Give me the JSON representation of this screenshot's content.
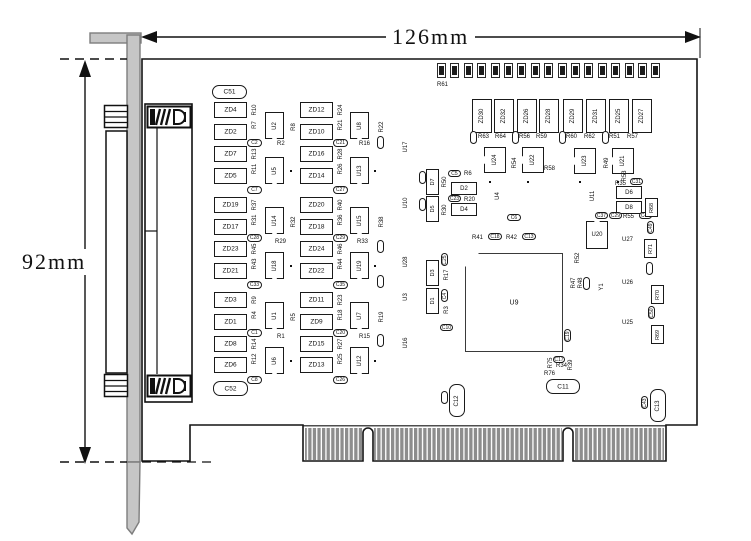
{
  "dimensions": {
    "width_label": "126mm",
    "height_label": "92mm"
  },
  "board": {
    "outline_color": "#141414",
    "bracket_fill": "#c6c6c6",
    "bracket_stroke": "#7d7d7d",
    "finger_color": "#8d8d8d",
    "background": "#ffffff"
  },
  "led_row": {
    "count": 17,
    "x": 437,
    "y": 63,
    "step": 13.4,
    "w": 9,
    "h": 15,
    "label": "R61"
  },
  "components": [
    {
      "t": "rr",
      "l": "C51",
      "x": 212,
      "y": 85,
      "w": 35,
      "h": 14
    },
    {
      "t": "zd",
      "l": "ZD4",
      "x": 214,
      "y": 102
    },
    {
      "t": "zd",
      "l": "ZD2",
      "x": 214,
      "y": 124
    },
    {
      "t": "zd",
      "l": "ZD7",
      "x": 214,
      "y": 146
    },
    {
      "t": "zd",
      "l": "ZD5",
      "x": 214,
      "y": 168
    },
    {
      "t": "zd",
      "l": "ZD19",
      "x": 214,
      "y": 197
    },
    {
      "t": "zd",
      "l": "ZD17",
      "x": 214,
      "y": 219
    },
    {
      "t": "zd",
      "l": "ZD23",
      "x": 214,
      "y": 241
    },
    {
      "t": "zd",
      "l": "ZD21",
      "x": 214,
      "y": 263
    },
    {
      "t": "zd",
      "l": "ZD3",
      "x": 214,
      "y": 292
    },
    {
      "t": "zd",
      "l": "ZD1",
      "x": 214,
      "y": 314
    },
    {
      "t": "zd",
      "l": "ZD8",
      "x": 214,
      "y": 336
    },
    {
      "t": "zd",
      "l": "ZD6",
      "x": 214,
      "y": 357
    },
    {
      "t": "zd",
      "l": "ZD12",
      "x": 300,
      "y": 102
    },
    {
      "t": "zd",
      "l": "ZD10",
      "x": 300,
      "y": 124
    },
    {
      "t": "zd",
      "l": "ZD16",
      "x": 300,
      "y": 146
    },
    {
      "t": "zd",
      "l": "ZD14",
      "x": 300,
      "y": 168
    },
    {
      "t": "zd",
      "l": "ZD20",
      "x": 300,
      "y": 197
    },
    {
      "t": "zd",
      "l": "ZD18",
      "x": 300,
      "y": 219
    },
    {
      "t": "zd",
      "l": "ZD24",
      "x": 300,
      "y": 241
    },
    {
      "t": "zd",
      "l": "ZD22",
      "x": 300,
      "y": 263
    },
    {
      "t": "zd",
      "l": "ZD11",
      "x": 300,
      "y": 292
    },
    {
      "t": "zd",
      "l": "ZD9",
      "x": 300,
      "y": 314
    },
    {
      "t": "zd",
      "l": "ZD15",
      "x": 300,
      "y": 336
    },
    {
      "t": "zd",
      "l": "ZD13",
      "x": 300,
      "y": 357
    },
    {
      "t": "vt",
      "l": "R10",
      "x": 250,
      "y": 103
    },
    {
      "t": "vt",
      "l": "R7",
      "x": 250,
      "y": 118
    },
    {
      "t": "cap",
      "l": "C2",
      "x": 247,
      "y": 139
    },
    {
      "t": "vt",
      "l": "R13",
      "x": 250,
      "y": 147
    },
    {
      "t": "vt",
      "l": "R11",
      "x": 250,
      "y": 162
    },
    {
      "t": "cap",
      "l": "C7",
      "x": 247,
      "y": 186
    },
    {
      "t": "vt",
      "l": "R37",
      "x": 250,
      "y": 198
    },
    {
      "t": "vt",
      "l": "R31",
      "x": 250,
      "y": 213
    },
    {
      "t": "cap",
      "l": "C28",
      "x": 247,
      "y": 234
    },
    {
      "t": "vt",
      "l": "R45",
      "x": 250,
      "y": 242
    },
    {
      "t": "vt",
      "l": "R43",
      "x": 250,
      "y": 257
    },
    {
      "t": "cap",
      "l": "C33",
      "x": 247,
      "y": 281
    },
    {
      "t": "vt",
      "l": "R9",
      "x": 250,
      "y": 293
    },
    {
      "t": "vt",
      "l": "R4",
      "x": 250,
      "y": 308
    },
    {
      "t": "cap",
      "l": "C1",
      "x": 247,
      "y": 329
    },
    {
      "t": "vt",
      "l": "R14",
      "x": 250,
      "y": 337
    },
    {
      "t": "vt",
      "l": "R12",
      "x": 250,
      "y": 352
    },
    {
      "t": "cap",
      "l": "C8",
      "x": 247,
      "y": 376
    },
    {
      "t": "vt",
      "l": "R24",
      "x": 336,
      "y": 103
    },
    {
      "t": "vt",
      "l": "R21",
      "x": 336,
      "y": 118
    },
    {
      "t": "cap",
      "l": "C21",
      "x": 333,
      "y": 139
    },
    {
      "t": "vt",
      "l": "R28",
      "x": 336,
      "y": 147
    },
    {
      "t": "vt",
      "l": "R26",
      "x": 336,
      "y": 162
    },
    {
      "t": "cap",
      "l": "C27",
      "x": 333,
      "y": 186
    },
    {
      "t": "vt",
      "l": "R40",
      "x": 336,
      "y": 198
    },
    {
      "t": "vt",
      "l": "R36",
      "x": 336,
      "y": 213
    },
    {
      "t": "cap",
      "l": "C29",
      "x": 333,
      "y": 234
    },
    {
      "t": "vt",
      "l": "R46",
      "x": 336,
      "y": 242
    },
    {
      "t": "vt",
      "l": "R44",
      "x": 336,
      "y": 257
    },
    {
      "t": "cap",
      "l": "C35",
      "x": 333,
      "y": 281
    },
    {
      "t": "vt",
      "l": "R23",
      "x": 336,
      "y": 293
    },
    {
      "t": "vt",
      "l": "R18",
      "x": 336,
      "y": 308
    },
    {
      "t": "cap",
      "l": "C20",
      "x": 333,
      "y": 329
    },
    {
      "t": "vt",
      "l": "R27",
      "x": 336,
      "y": 337
    },
    {
      "t": "vt",
      "l": "R25",
      "x": 336,
      "y": 352
    },
    {
      "t": "cap",
      "l": "C26",
      "x": 333,
      "y": 376
    },
    {
      "t": "u",
      "l": "U2",
      "x": 265,
      "y": 112
    },
    {
      "t": "u",
      "l": "U5",
      "x": 265,
      "y": 157
    },
    {
      "t": "u",
      "l": "U14",
      "x": 265,
      "y": 207
    },
    {
      "t": "u",
      "l": "U18",
      "x": 265,
      "y": 252
    },
    {
      "t": "u",
      "l": "U1",
      "x": 265,
      "y": 302
    },
    {
      "t": "u",
      "l": "U6",
      "x": 265,
      "y": 347
    },
    {
      "t": "u",
      "l": "U8",
      "x": 350,
      "y": 112
    },
    {
      "t": "u",
      "l": "U13",
      "x": 350,
      "y": 157
    },
    {
      "t": "u",
      "l": "U15",
      "x": 350,
      "y": 207
    },
    {
      "t": "u",
      "l": "U19",
      "x": 350,
      "y": 252
    },
    {
      "t": "u",
      "l": "U7",
      "x": 350,
      "y": 302
    },
    {
      "t": "u",
      "l": "U12",
      "x": 350,
      "y": 347
    },
    {
      "t": "ht",
      "l": "R2",
      "x": 277,
      "y": 140
    },
    {
      "t": "ht",
      "l": "R16",
      "x": 359,
      "y": 140
    },
    {
      "t": "ht",
      "l": "R29",
      "x": 275,
      "y": 238
    },
    {
      "t": "ht",
      "l": "R33",
      "x": 357,
      "y": 238
    },
    {
      "t": "ht",
      "l": "R1",
      "x": 277,
      "y": 333
    },
    {
      "t": "ht",
      "l": "R15",
      "x": 359,
      "y": 333
    },
    {
      "t": "vt",
      "l": "R8",
      "x": 289,
      "y": 120
    },
    {
      "t": "vt",
      "l": "R32",
      "x": 289,
      "y": 215
    },
    {
      "t": "vt",
      "l": "R5",
      "x": 289,
      "y": 310
    },
    {
      "t": "vt",
      "l": "R22",
      "x": 377,
      "y": 120
    },
    {
      "t": "vt",
      "l": "R38",
      "x": 377,
      "y": 215
    },
    {
      "t": "vt",
      "l": "R19",
      "x": 377,
      "y": 310
    },
    {
      "t": "capv",
      "l": "",
      "x": 377,
      "y": 136
    },
    {
      "t": "capv",
      "l": "",
      "x": 377,
      "y": 240
    },
    {
      "t": "capv",
      "l": "",
      "x": 377,
      "y": 275
    },
    {
      "t": "capv",
      "l": "",
      "x": 377,
      "y": 334
    },
    {
      "t": "vt",
      "l": "U17",
      "x": 401,
      "y": 140
    },
    {
      "t": "vt",
      "l": "U10",
      "x": 401,
      "y": 196
    },
    {
      "t": "vt",
      "l": "U28",
      "x": 401,
      "y": 255
    },
    {
      "t": "vt",
      "l": "U3",
      "x": 401,
      "y": 290
    },
    {
      "t": "vt",
      "l": "U16",
      "x": 401,
      "y": 336
    },
    {
      "t": "dot",
      "x": 290,
      "y": 170
    },
    {
      "t": "dot",
      "x": 290,
      "y": 265
    },
    {
      "t": "dot",
      "x": 290,
      "y": 360
    },
    {
      "t": "dot",
      "x": 374,
      "y": 170
    },
    {
      "t": "dot",
      "x": 374,
      "y": 265
    },
    {
      "t": "dot",
      "x": 374,
      "y": 360
    },
    {
      "t": "zdv",
      "l": "ZD30",
      "x": 472,
      "y": 99
    },
    {
      "t": "zdv",
      "l": "ZD32",
      "x": 494,
      "y": 99
    },
    {
      "t": "zdv",
      "l": "ZD26",
      "x": 517,
      "y": 99
    },
    {
      "t": "zdv",
      "l": "ZD28",
      "x": 539,
      "y": 99
    },
    {
      "t": "zdv",
      "l": "ZD29",
      "x": 563,
      "y": 99
    },
    {
      "t": "zdv",
      "l": "ZD31",
      "x": 586,
      "y": 99
    },
    {
      "t": "zdv",
      "l": "ZD25",
      "x": 609,
      "y": 99
    },
    {
      "t": "zdv",
      "l": "ZD27",
      "x": 632,
      "y": 99
    },
    {
      "t": "capv",
      "l": "",
      "x": 470,
      "y": 131
    },
    {
      "t": "ht",
      "l": "R63",
      "x": 478,
      "y": 133
    },
    {
      "t": "ht",
      "l": "R64",
      "x": 495,
      "y": 133
    },
    {
      "t": "capv",
      "l": "",
      "x": 512,
      "y": 131
    },
    {
      "t": "ht",
      "l": "R56",
      "x": 519,
      "y": 133
    },
    {
      "t": "ht",
      "l": "R59",
      "x": 536,
      "y": 133
    },
    {
      "t": "capv",
      "l": "",
      "x": 559,
      "y": 131
    },
    {
      "t": "ht",
      "l": "R60",
      "x": 566,
      "y": 133
    },
    {
      "t": "ht",
      "l": "R62",
      "x": 584,
      "y": 133
    },
    {
      "t": "capv",
      "l": "",
      "x": 602,
      "y": 131
    },
    {
      "t": "ht",
      "l": "R51",
      "x": 609,
      "y": 133
    },
    {
      "t": "ht",
      "l": "R57",
      "x": 627,
      "y": 133
    },
    {
      "t": "ul",
      "l": "U24",
      "x": 484,
      "y": 147
    },
    {
      "t": "ul",
      "l": "U22",
      "x": 522,
      "y": 147
    },
    {
      "t": "ul",
      "l": "U23",
      "x": 574,
      "y": 148
    },
    {
      "t": "ul",
      "l": "U21",
      "x": 612,
      "y": 148
    },
    {
      "t": "vt",
      "l": "R54",
      "x": 510,
      "y": 156
    },
    {
      "t": "ht",
      "l": "R58",
      "x": 544,
      "y": 165
    },
    {
      "t": "vt",
      "l": "R49",
      "x": 602,
      "y": 156
    },
    {
      "t": "dot",
      "x": 489,
      "y": 181
    },
    {
      "t": "dot",
      "x": 527,
      "y": 181
    },
    {
      "t": "dot",
      "x": 579,
      "y": 181
    },
    {
      "t": "dot",
      "x": 617,
      "y": 181
    },
    {
      "t": "capv",
      "l": "",
      "x": 419,
      "y": 171
    },
    {
      "t": "rectv",
      "l": "D7",
      "x": 426,
      "y": 169,
      "w": 13,
      "h": 26
    },
    {
      "t": "vt",
      "l": "R50",
      "x": 440,
      "y": 175
    },
    {
      "t": "capv",
      "l": "",
      "x": 419,
      "y": 198
    },
    {
      "t": "rectv",
      "l": "D5",
      "x": 426,
      "y": 196,
      "w": 13,
      "h": 26
    },
    {
      "t": "vt",
      "l": "R30",
      "x": 440,
      "y": 203
    },
    {
      "t": "cap",
      "l": "C5",
      "x": 448,
      "y": 170,
      "w": 13,
      "h": 7
    },
    {
      "t": "ht",
      "l": "R6",
      "x": 464,
      "y": 170
    },
    {
      "t": "rect",
      "l": "D2",
      "x": 451,
      "y": 182
    },
    {
      "t": "cap",
      "l": "C23",
      "x": 448,
      "y": 195,
      "w": 13,
      "h": 7
    },
    {
      "t": "ht",
      "l": "R20",
      "x": 464,
      "y": 196
    },
    {
      "t": "rect",
      "l": "D4",
      "x": 451,
      "y": 203
    },
    {
      "t": "vt",
      "l": "U4",
      "x": 493,
      "y": 189
    },
    {
      "t": "cap",
      "l": "C6",
      "x": 507,
      "y": 214,
      "w": 14,
      "h": 7
    },
    {
      "t": "ht",
      "l": "R41",
      "x": 472,
      "y": 234
    },
    {
      "t": "cap",
      "l": "C18",
      "x": 488,
      "y": 233,
      "w": 14,
      "h": 7
    },
    {
      "t": "ht",
      "l": "R42",
      "x": 506,
      "y": 234
    },
    {
      "t": "cap",
      "l": "C13",
      "x": 522,
      "y": 233,
      "w": 14,
      "h": 7
    },
    {
      "t": "capv",
      "l": "C25",
      "x": 441,
      "y": 253
    },
    {
      "t": "vt",
      "l": "R17",
      "x": 442,
      "y": 268
    },
    {
      "t": "rectv",
      "l": "D3",
      "x": 426,
      "y": 260,
      "w": 13,
      "h": 26
    },
    {
      "t": "capv",
      "l": "C4",
      "x": 441,
      "y": 289
    },
    {
      "t": "vt",
      "l": "R3",
      "x": 442,
      "y": 303
    },
    {
      "t": "rectv",
      "l": "D1",
      "x": 426,
      "y": 288,
      "w": 13,
      "h": 26
    },
    {
      "t": "cap",
      "l": "C10",
      "x": 440,
      "y": 324,
      "w": 13,
      "h": 7
    },
    {
      "t": "chip",
      "l": "U9",
      "x": 465,
      "y": 253,
      "w": 98,
      "h": 99
    },
    {
      "t": "vt",
      "l": "R52",
      "x": 573,
      "y": 251
    },
    {
      "t": "vt",
      "l": "R47",
      "x": 569,
      "y": 276
    },
    {
      "t": "vt",
      "l": "R48",
      "x": 576,
      "y": 276
    },
    {
      "t": "capv",
      "l": "",
      "x": 583,
      "y": 277
    },
    {
      "t": "vt",
      "l": "Y1",
      "x": 597,
      "y": 280
    },
    {
      "t": "capv",
      "l": "C19",
      "x": 564,
      "y": 329
    },
    {
      "t": "un",
      "l": "U20",
      "x": 586,
      "y": 221,
      "w": 22,
      "h": 28
    },
    {
      "t": "vt",
      "l": "U11",
      "x": 588,
      "y": 189
    },
    {
      "t": "vt",
      "l": "R53",
      "x": 620,
      "y": 169
    },
    {
      "t": "ht",
      "l": "R35",
      "x": 615,
      "y": 180
    },
    {
      "t": "cap",
      "l": "C31",
      "x": 630,
      "y": 178,
      "w": 13,
      "h": 7
    },
    {
      "t": "rect",
      "l": "D6",
      "x": 616,
      "y": 186
    },
    {
      "t": "rect",
      "l": "D8",
      "x": 616,
      "y": 201
    },
    {
      "t": "cap",
      "l": "C37",
      "x": 595,
      "y": 212,
      "w": 13,
      "h": 7
    },
    {
      "t": "cap",
      "l": "C29",
      "x": 609,
      "y": 212,
      "w": 13,
      "h": 7
    },
    {
      "t": "ht",
      "l": "R55",
      "x": 623,
      "y": 213
    },
    {
      "t": "cap",
      "l": "C42",
      "x": 639,
      "y": 212,
      "w": 13,
      "h": 7
    },
    {
      "t": "rectv",
      "l": "R68",
      "x": 645,
      "y": 198
    },
    {
      "t": "capv",
      "l": "C49",
      "x": 647,
      "y": 221
    },
    {
      "t": "ht",
      "l": "U27",
      "x": 622,
      "y": 236
    },
    {
      "t": "rectv",
      "l": "R71",
      "x": 644,
      "y": 239
    },
    {
      "t": "capv",
      "l": "",
      "x": 646,
      "y": 262
    },
    {
      "t": "ht",
      "l": "U26",
      "x": 622,
      "y": 279
    },
    {
      "t": "rectv",
      "l": "R70",
      "x": 651,
      "y": 285
    },
    {
      "t": "capv",
      "l": "C50",
      "x": 648,
      "y": 306
    },
    {
      "t": "ht",
      "l": "U25",
      "x": 622,
      "y": 319
    },
    {
      "t": "rectv",
      "l": "R69",
      "x": 651,
      "y": 325
    },
    {
      "t": "vt",
      "l": "R75",
      "x": 546,
      "y": 356
    },
    {
      "t": "cap",
      "l": "C17",
      "x": 553,
      "y": 356,
      "w": 12,
      "h": 7
    },
    {
      "t": "ht",
      "l": "R34",
      "x": 556,
      "y": 362
    },
    {
      "t": "vt",
      "l": "R39",
      "x": 566,
      "y": 358
    },
    {
      "t": "ht",
      "l": "R76",
      "x": 544,
      "y": 370
    },
    {
      "t": "rr",
      "l": "C11",
      "x": 546,
      "y": 379,
      "w": 34,
      "h": 15
    },
    {
      "t": "capv",
      "l": "",
      "x": 441,
      "y": 391
    },
    {
      "t": "rrv",
      "l": "C12",
      "x": 449,
      "y": 384
    },
    {
      "t": "capv",
      "l": "C43",
      "x": 641,
      "y": 396
    },
    {
      "t": "rrv",
      "l": "C13",
      "x": 650,
      "y": 389
    },
    {
      "t": "rr",
      "l": "C52",
      "x": 213,
      "y": 381,
      "w": 35,
      "h": 15
    }
  ]
}
